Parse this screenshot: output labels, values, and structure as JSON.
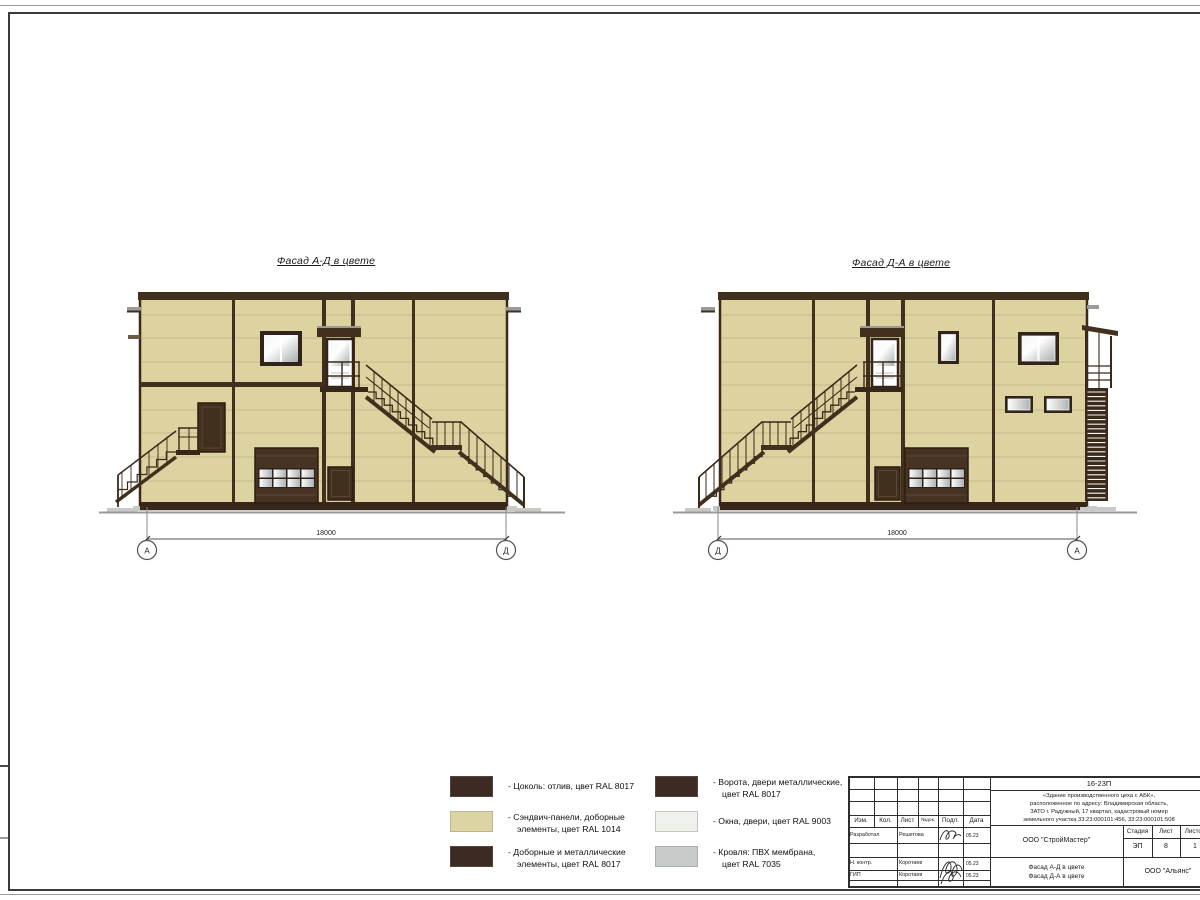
{
  "sheet": {
    "kind": "facade color elevation drawing"
  },
  "facades": {
    "left": {
      "title": "Фасад А-Д в цвете",
      "dim": "18000",
      "axis_left": "А",
      "axis_right": "Д"
    },
    "right": {
      "title": "Фасад Д-А в цвете",
      "dim": "18000",
      "axis_left": "Д",
      "axis_right": "А"
    }
  },
  "palette": {
    "panel_tan": "#dcd3a0",
    "trim_dark_brown": "#42301e",
    "window_grey": "#b9bfbe",
    "ground_grey": "#9a9a97"
  },
  "legend": {
    "items": [
      {
        "color": "#3d2b23",
        "lines": [
          "- Цоколь: отлив, цвет RAL 8017",
          ""
        ]
      },
      {
        "color": "#ddd4a4",
        "lines": [
          "- Сэндвич-панели, доборные",
          "элементы, цвет RAL 1014"
        ]
      },
      {
        "color": "#3d2b23",
        "lines": [
          "- Доборные и металлические",
          "элементы, цвет RAL 8017"
        ]
      },
      {
        "color": "#3d2b23",
        "lines": [
          "- Ворота, двери металлические,",
          "цвет RAL 8017"
        ]
      },
      {
        "color": "#eef1ec",
        "lines": [
          "- Окна, двери, цвет RAL 9003",
          ""
        ]
      },
      {
        "color": "#c7cccb",
        "lines": [
          "- Кровля: ПВХ мембрана,",
          "цвет RAL 7035"
        ]
      }
    ]
  },
  "titleblock": {
    "code": "16-23П",
    "address_lines": [
      "«Здание производственного цеха с АБК»,",
      "расположенное по адресу: Владимирская область,",
      "ЗАТО г. Радужный, 17 квартал, кадастровый номер",
      "земельного участка 33:23:000101:456, 33:23:000101:508"
    ],
    "header_cols": [
      "Изм.",
      "Кол.",
      "Лист",
      "№док.",
      "Подл.",
      "Дата"
    ],
    "rows": [
      {
        "role": "Разработал",
        "name": "Решетова",
        "date": "05.23"
      },
      {
        "role": "Н. контр.",
        "name": "Коротаев",
        "date": "05.23"
      },
      {
        "role": "ГИП",
        "name": "Коротаев",
        "date": "05.23"
      }
    ],
    "company": "ООО \"СтройМастер\"",
    "stage_label": "Стадия",
    "sheet_label": "Лист",
    "sheets_label": "Листов",
    "stage": "ЭП",
    "sheet": "8",
    "sheets": "1",
    "sheet_title_lines": [
      "Фасад А-Д в цвете",
      "Фасад Д-А в цвете"
    ],
    "org": "ООО \"Альянс\""
  }
}
